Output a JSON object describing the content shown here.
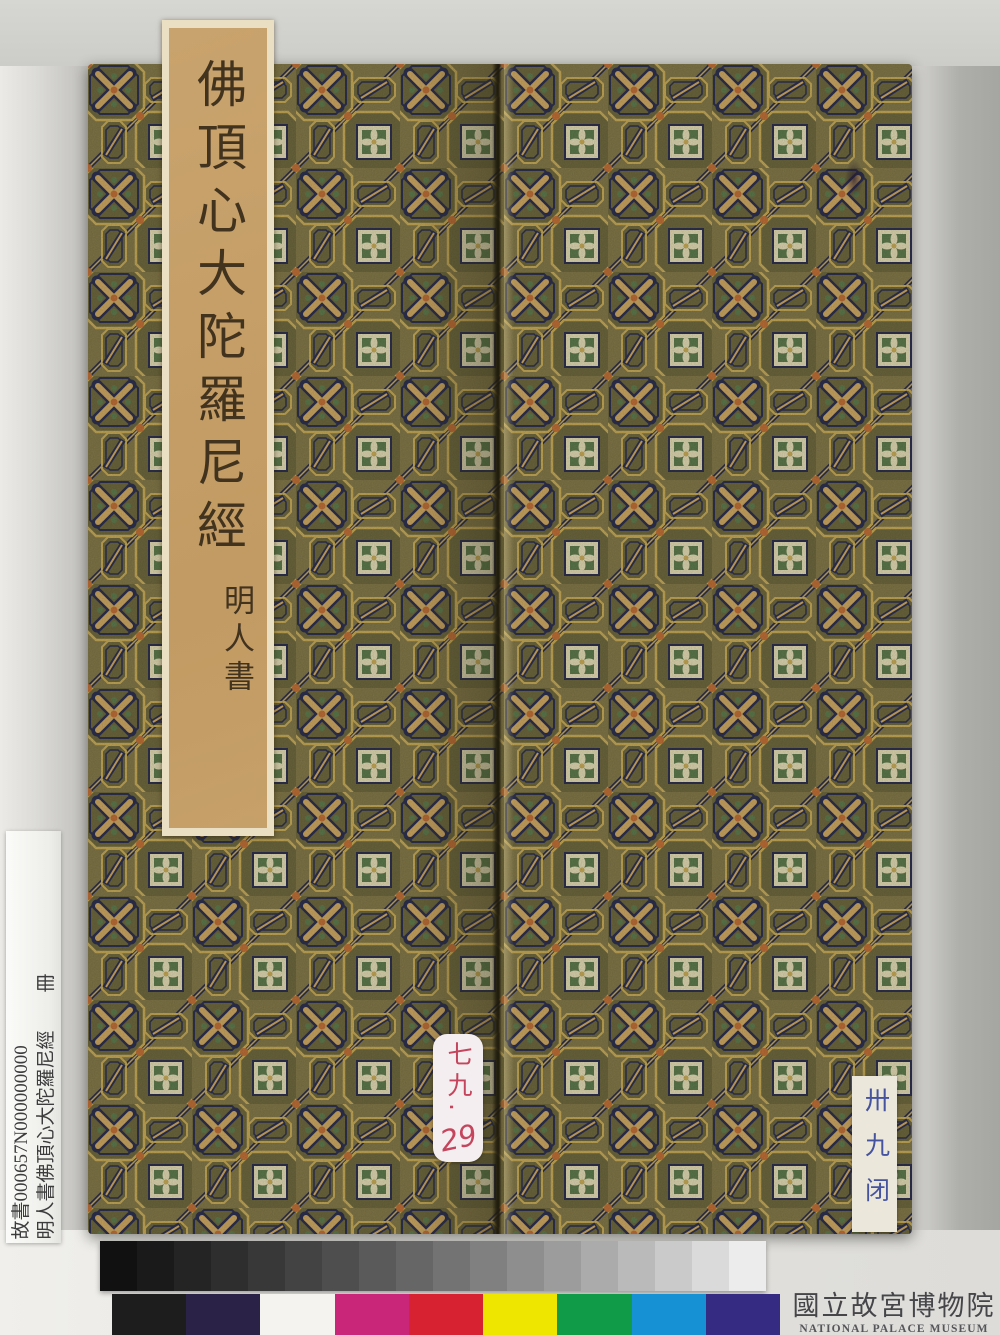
{
  "book": {
    "title_label": {
      "title": "佛頂心大陀羅尼經",
      "byline": "明人書"
    },
    "pink_tag": {
      "line1": "七九.",
      "line2": "29"
    },
    "blue_tag": {
      "text": "卅九闭"
    }
  },
  "catalog_label": {
    "line1": "故書000657N000000000",
    "line2": "明人書佛頂心大陀羅尼經　　冊"
  },
  "museum_mark": {
    "chinese": "國立故宮博物院",
    "english": "NATIONAL PALACE MUSEUM"
  },
  "color_bar": {
    "grayscale": [
      "#111111",
      "#1a1a1a",
      "#242424",
      "#2e2e2e",
      "#383838",
      "#434343",
      "#4e4e4e",
      "#5a5a5a",
      "#666666",
      "#737373",
      "#808080",
      "#8e8e8e",
      "#9c9c9c",
      "#ababab",
      "#bababa",
      "#cacaca",
      "#dadada",
      "#ececec"
    ],
    "patches": [
      "#1d1d1d",
      "#2b2347",
      "#f4f3ef",
      "#c92679",
      "#d62231",
      "#efe600",
      "#0f9b48",
      "#1692d4",
      "#362b82"
    ]
  },
  "colors": {
    "fabric_ground": "#84794a",
    "fabric_navy": "#2e3150",
    "fabric_gold": "#c8ab58",
    "fabric_tan": "#cfa963",
    "fabric_green": "#5f7b4d",
    "fabric_cream": "#e3dbb5",
    "fabric_orange": "#c07038",
    "label_tan": "#c9a36d",
    "title_ink": "#42331f",
    "pink_ink": "#c5455c",
    "blue_ink": "#4553a0"
  }
}
